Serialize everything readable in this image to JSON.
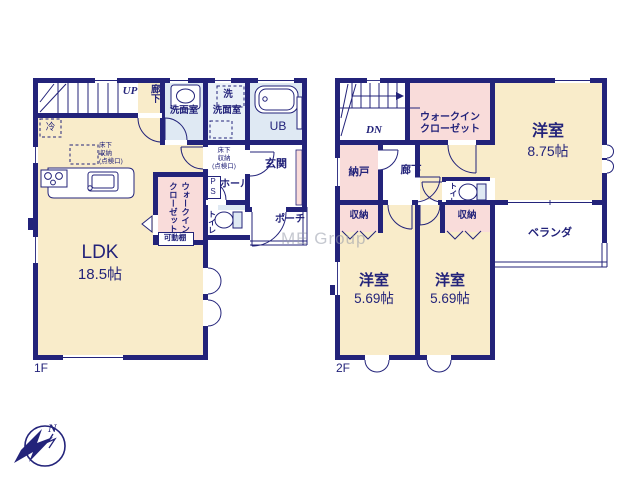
{
  "watermark": "ME Group",
  "compass": {
    "north": "N"
  },
  "colors": {
    "wall": "#23237a",
    "room_cream": "#f9ecca",
    "room_pink": "#f9dcda",
    "room_blue": "#dfe9f3",
    "room_blue_light": "#eaf1f8",
    "text": "#23237a",
    "watermark": "#969baa"
  },
  "floor1": {
    "label": "1F",
    "stairs": "UP",
    "corridor": "廊下",
    "fridge": "冷",
    "underfloor_storage_kitchen": "床下\n収納\n(点検口)",
    "washroom1": "洗面室",
    "laundry": "洗",
    "washroom2": "洗面室",
    "bath": "UB",
    "underfloor_storage_hall": "床下\n収納\n(点検口)",
    "entrance": "玄関",
    "pipe_space": "P\nS",
    "hall": "ホール",
    "walk_in_closet": "ウォークイン\nクローゼット",
    "movable_shelf": "可動棚",
    "toilet": "トイレ",
    "porch": "ポーチ",
    "ldk_name": "LDK",
    "ldk_size": "18.5帖"
  },
  "floor2": {
    "label": "2F",
    "stairs": "DN",
    "walk_in_closet": "ウォークイン\nクローゼット",
    "bedroom_main_name": "洋室",
    "bedroom_main_size": "8.75帖",
    "storage_room": "納戸",
    "corridor": "廊下",
    "toilet": "トイレ",
    "closet_left": "収納",
    "closet_right": "収納",
    "bedroom2_name": "洋室",
    "bedroom2_size": "5.69帖",
    "bedroom3_name": "洋室",
    "bedroom3_size": "5.69帖",
    "veranda": "ベランダ"
  }
}
